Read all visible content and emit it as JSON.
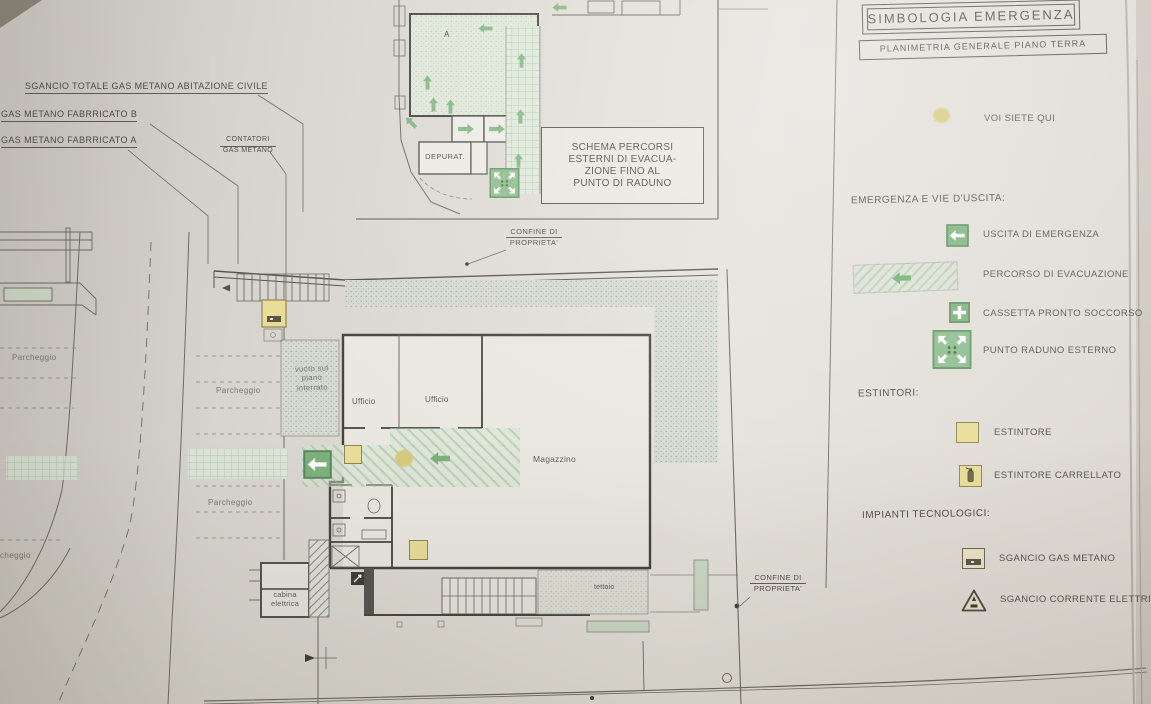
{
  "title_block": {
    "title": "SIMBOLOGIA EMERGENZA",
    "subtitle": "PLANIMETRIA GENERALE PIANO TERRA"
  },
  "legend": {
    "you_are_here": {
      "icon": "you-are-here-dot",
      "label": "VOI SIETE QUI"
    },
    "emergency_section": {
      "heading": "EMERGENZA E VIE D'USCITA:",
      "items": [
        {
          "icon": "emergency-exit-icon",
          "label": "USCITA DI EMERGENZA"
        },
        {
          "icon": "evacuation-route-icon",
          "label": "PERCORSO DI EVACUAZIONE"
        },
        {
          "icon": "first-aid-box-icon",
          "label": "CASSETTA PRONTO SOCCORSO"
        },
        {
          "icon": "assembly-point-icon",
          "label": "PUNTO RADUNO ESTERNO"
        }
      ]
    },
    "extinguisher_section": {
      "heading": "ESTINTORI:",
      "items": [
        {
          "icon": "extinguisher-icon",
          "label": "ESTINTORE"
        },
        {
          "icon": "wheeled-extinguisher-icon",
          "label": "ESTINTORE CARRELLATO"
        }
      ]
    },
    "systems_section": {
      "heading": "IMPIANTI TECNOLOGICI:",
      "items": [
        {
          "icon": "gas-shutoff-icon",
          "label": "SGANCIO GAS METANO"
        },
        {
          "icon": "electric-shutoff-icon",
          "label": "SGANCIO CORRENTE ELETTRICA"
        }
      ]
    }
  },
  "callouts": {
    "gas_total_shutoff": "SGANCIO TOTALE GAS METANO ABITAZIONE CIVILE",
    "gas_building_b": "GAS METANO FABRRICATO B",
    "gas_building_a": "GAS METANO FABRRICATO A",
    "gas_meters": [
      "CONTATORI",
      "GAS METANO"
    ],
    "boundary_top": [
      "CONFINE DI",
      "PROPRIETA'"
    ],
    "boundary_right": [
      "CONFINE DI",
      "PROPRIETA'"
    ]
  },
  "inset": {
    "note": [
      "SCHEMA PERCORSI",
      "ESTERNI DI EVACUA-",
      "ZIONE FINO AL",
      "PUNTO DI RADUNO"
    ],
    "depurator": "DEPURAT.",
    "block_mark": "A"
  },
  "plan": {
    "rooms": {
      "office_left": "Ufficio",
      "office_right": "Ufficio",
      "warehouse": "Magazzino",
      "canopy": "tettoio",
      "electrical_cabin": [
        "cabina",
        "elettrica"
      ],
      "void_note": [
        "vuoto sul",
        "piano",
        "interrato"
      ]
    },
    "parking": {
      "left": "Parcheggio",
      "middle": "Parcheggio",
      "lower": "Parcheggio",
      "partial": "cheggio"
    }
  },
  "colors": {
    "emergency_green": "#7cb17c",
    "extinguisher_yellow": "#e9dd97",
    "paper": "#dcd9d2",
    "line": "#55534e"
  }
}
